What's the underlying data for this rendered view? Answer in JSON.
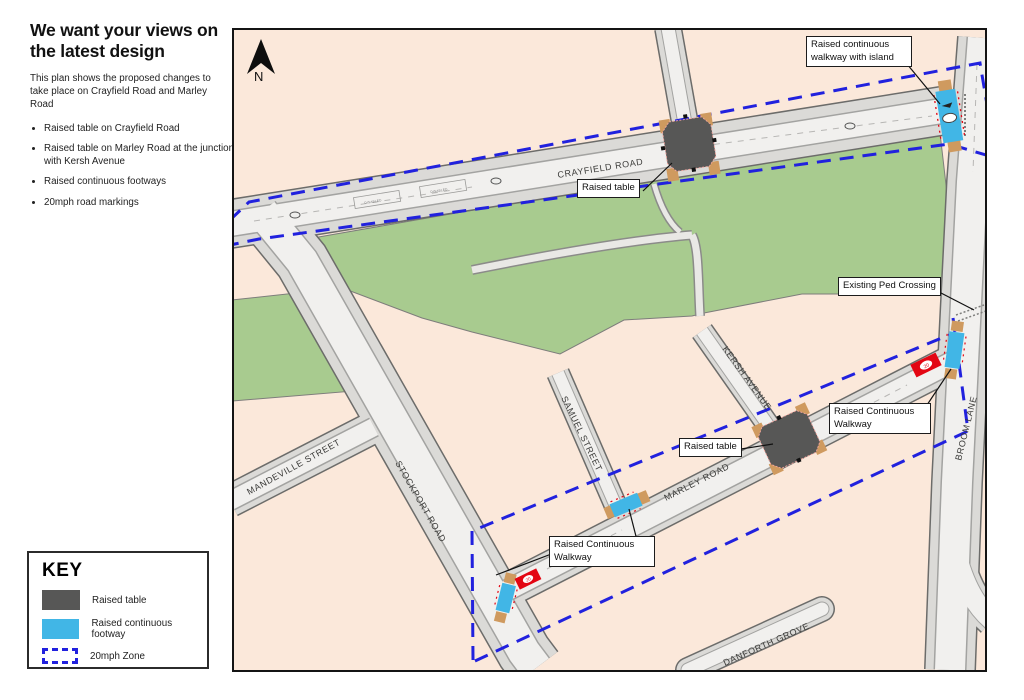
{
  "panel": {
    "title": "We want your views on the latest design",
    "intro": "This plan shows the proposed changes to take place on Crayfield Road and Marley Road",
    "bullets": [
      "Raised table on Crayfield Road",
      "Raised table on Marley Road at the junction with Kersh Avenue",
      "Raised continuous footways",
      "20mph road markings"
    ]
  },
  "key": {
    "title": "KEY",
    "items": [
      {
        "label": "Raised table"
      },
      {
        "label": "Raised continuous footway"
      },
      {
        "label": "20mph Zone"
      }
    ]
  },
  "map": {
    "north": "N",
    "streets": [
      {
        "name": "CRAYFIELD ROAD"
      },
      {
        "name": "STOCKPORT ROAD"
      },
      {
        "name": "MANDEVILLE STREET"
      },
      {
        "name": "SAMUEL STREET"
      },
      {
        "name": "KERSH AVENUE"
      },
      {
        "name": "MARLEY ROAD"
      },
      {
        "name": "BROOM LANE"
      },
      {
        "name": "DANFORTH GROVE"
      }
    ],
    "callouts": [
      {
        "label": "Raised continuous walkway with island"
      },
      {
        "label": "Raised table"
      },
      {
        "label": "Existing Ped Crossing"
      },
      {
        "label": "Raised Continuous Walkway"
      },
      {
        "label": "Raised table"
      },
      {
        "label": "Raised Continuous Walkway"
      }
    ],
    "markings": {
      "disabled_bay": "DISABLED",
      "speed_roundel": "20"
    },
    "colors": {
      "zone_blue": "#2121de",
      "footway_cyan": "#41b6e6",
      "table_grey": "#575756",
      "marking_red": "#e30613",
      "park_green": "#a8cb8f",
      "map_background": "#fbe8da"
    }
  }
}
